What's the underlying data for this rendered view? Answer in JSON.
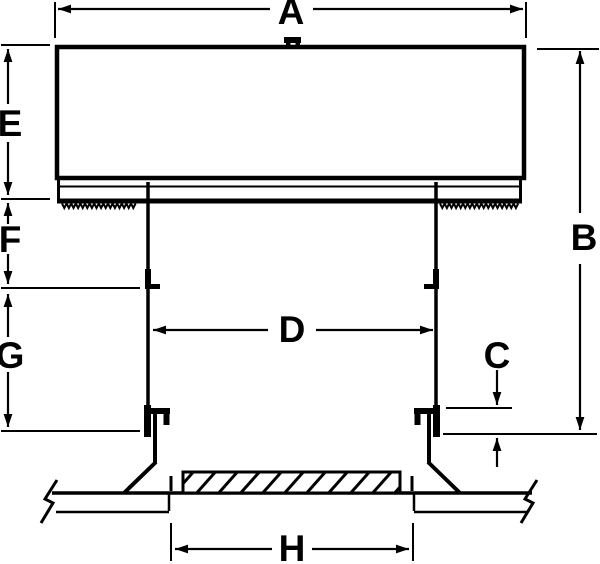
{
  "diagram": {
    "background_color": "#ffffff",
    "line_color": "#000000",
    "labels": {
      "A": "A",
      "B": "B",
      "C": "C",
      "D": "D",
      "E": "E",
      "F": "F",
      "G": "G",
      "H": "H"
    }
  }
}
